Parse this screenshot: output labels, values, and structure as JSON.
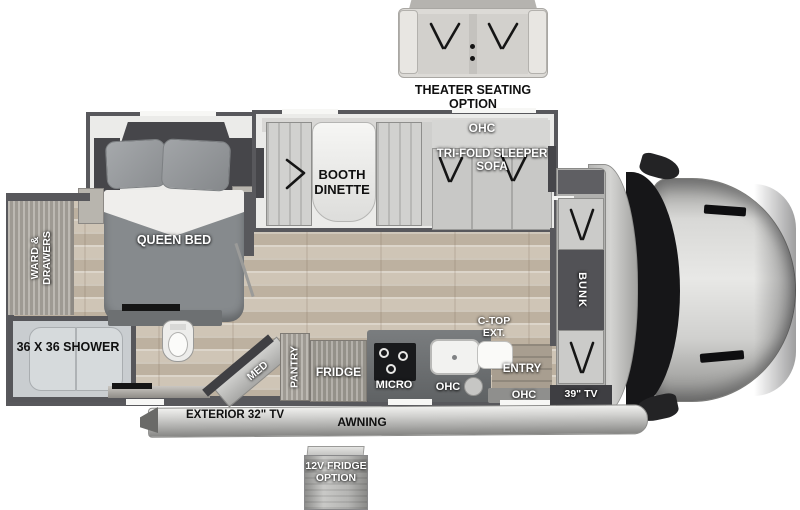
{
  "diagram": {
    "type": "rv-motorhome-floorplan",
    "options": {
      "theater": "THEATER SEATING OPTION",
      "fridge12v": "12V FRIDGE OPTION"
    },
    "bedroom": {
      "bed": "QUEEN BED",
      "wardrobe": "WARD & DRAWERS"
    },
    "bathroom": {
      "shower": "36 X 36 SHOWER",
      "med_cabinet": "MED"
    },
    "living": {
      "dinette": "BOOTH DINETTE",
      "sofa": "TRI-FOLD SLEEPER SOFA",
      "sofa_ohc": "OHC"
    },
    "kitchen": {
      "pantry": "PANTRY",
      "fridge": "FRIDGE",
      "micro": "MICRO",
      "ohc": "OHC",
      "ctop_ext": "C-TOP EXT."
    },
    "front": {
      "entry": "ENTRY",
      "entry_ohc": "OHC",
      "tv": "39\" TV",
      "bunk": "BUNK"
    },
    "exterior": {
      "awning": "AWNING",
      "tv": "EXTERIOR 32\" TV"
    }
  },
  "colors": {
    "wall": "#58585c",
    "floor_wood": "#c9beaf",
    "cabinet_wood": "#aba79f",
    "slide_fill": "#ebebe9",
    "counter": "#6b6e70",
    "cooktop": "#191a1c",
    "cab_body": "#c8c8c6",
    "windshield": "#161618",
    "label_white": "#ffffff",
    "label_black": "#101010"
  }
}
